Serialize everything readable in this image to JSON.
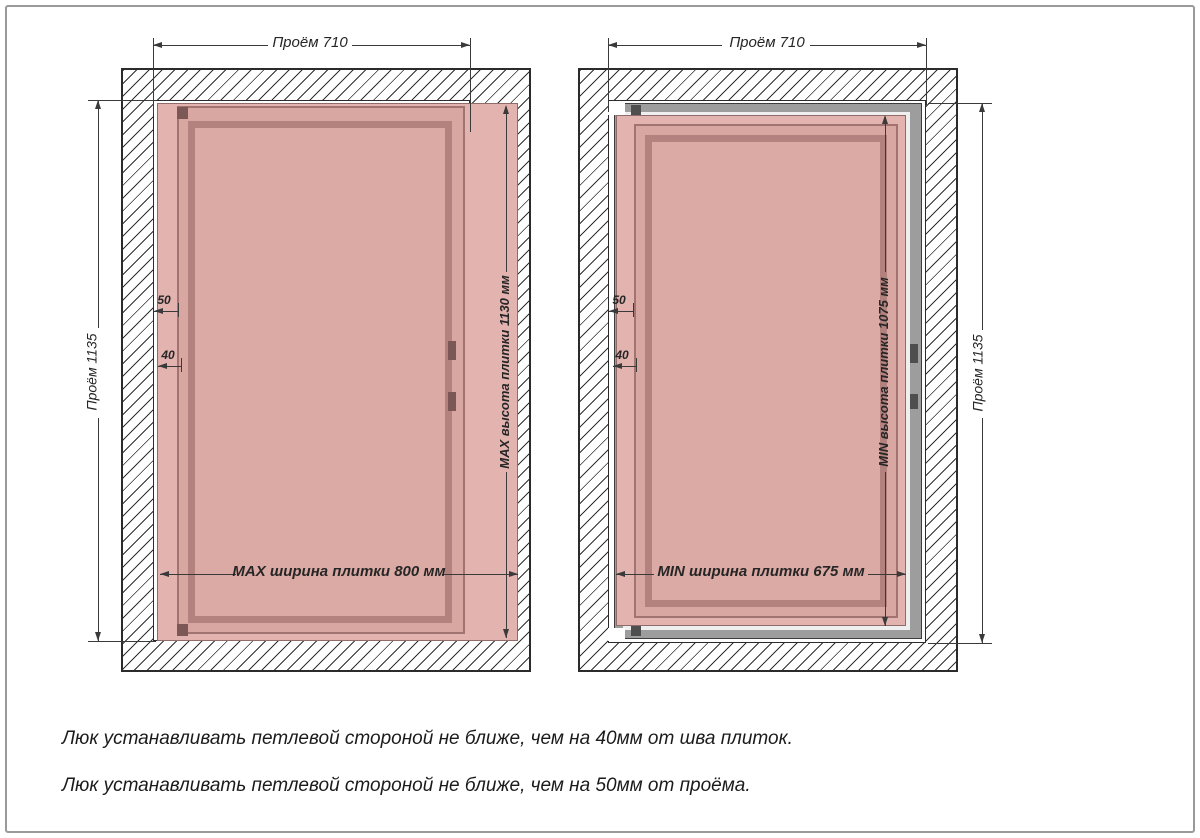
{
  "diagrams": [
    {
      "name": "max-tile-size",
      "opening_width": "Проём 710",
      "opening_height": "Проём 1135",
      "tile_height": "MAX высота плитки 1130 мм",
      "tile_width": "MAX ширина плитки 800 мм",
      "offset_from_opening": "50",
      "offset_from_seam": "40"
    },
    {
      "name": "min-tile-size",
      "opening_width": "Проём 710",
      "opening_height": "Проём 1135",
      "tile_height": "MIN высота плитки 1075 мм",
      "tile_width": "MIN ширина плитки 675 мм",
      "offset_from_opening": "50",
      "offset_from_seam": "40"
    }
  ],
  "notes": [
    "Люк устанавливать петлевой стороной не ближе, чем на 40мм от шва плиток.",
    "Люк устанавливать петлевой стороной не ближе, чем на 50мм от проёма."
  ],
  "colors": {
    "tile": "#e3b3b0",
    "door_panel": "#dcaaa4",
    "frame_band": "#b3817e",
    "metal_frame": "#9d9d9d",
    "wall_hatch_line": "#2f2f2f",
    "dimension_line": "#3a3a3a"
  }
}
